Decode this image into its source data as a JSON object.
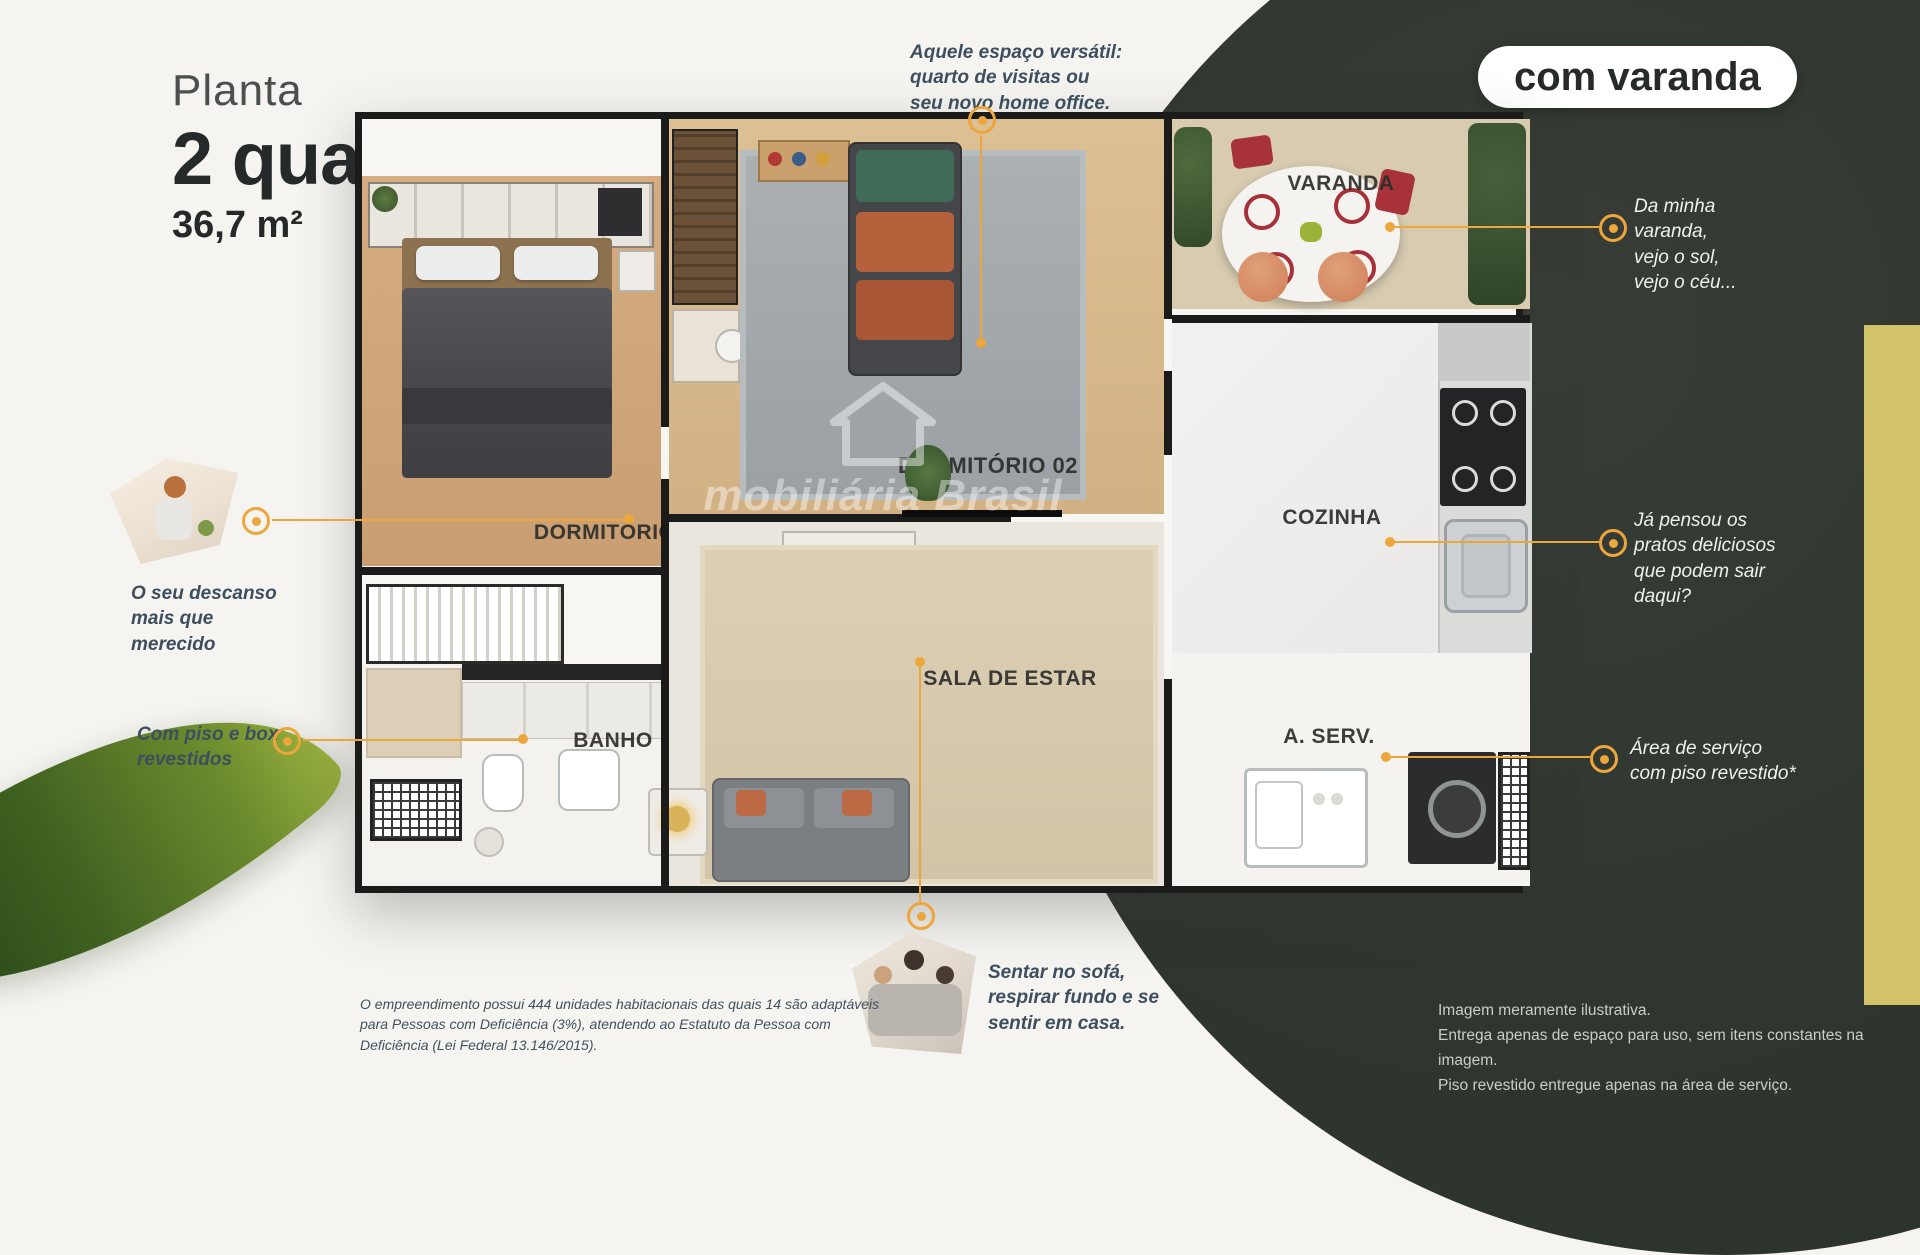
{
  "title": {
    "kicker": "Planta",
    "main": "2 quartos",
    "area": "36,7 m²"
  },
  "badge": {
    "label": "com varanda"
  },
  "rooms": {
    "dorm1": "DORMITÓRIO 01",
    "dorm2": "DORMITÓRIO 02",
    "varanda": "VARANDA",
    "cozinha": "COZINHA",
    "sala": "SALA DE ESTAR",
    "banho": "BANHO",
    "aserv": "A. SERV."
  },
  "annotations": {
    "office": "Aquele espaço versátil:\nquarto de visitas ou\nseu novo home office.",
    "bed": "O seu descanso\nmais que\nmerecido",
    "banho": "Com piso e box\nrevestidos",
    "varanda": "Da minha\nvaranda,\nvejo o sol,\nvejo o céu...",
    "cozinha": "Já pensou os\npratos deliciosos\nque podem sair\ndaqui?",
    "aserv": "Área de serviço\ncom piso revestido*",
    "sofa": "Sentar no sofá,\nrespirar fundo e se\nsentir em casa."
  },
  "disclaimers": {
    "left": "O empreendimento possui 444 unidades habitacionais das quais 14 são adaptáveis\npara Pessoas com Deficiência (3%), atendendo ao Estatuto da Pessoa com\nDeficiência (Lei Federal 13.146/2015).",
    "right_lines": [
      "Imagem meramente ilustrativa.",
      "Entrega apenas de espaço para uso, sem itens constantes na imagem.",
      "Piso revestido entregue apenas na área de serviço."
    ]
  },
  "watermark": {
    "text": "mobiliária Brasil"
  },
  "colors": {
    "accent": "#EDA63B",
    "panel": "#31372F",
    "strip": "#D2C269",
    "note_dark": "#3D4F5E",
    "badge_text": "#272B28"
  }
}
